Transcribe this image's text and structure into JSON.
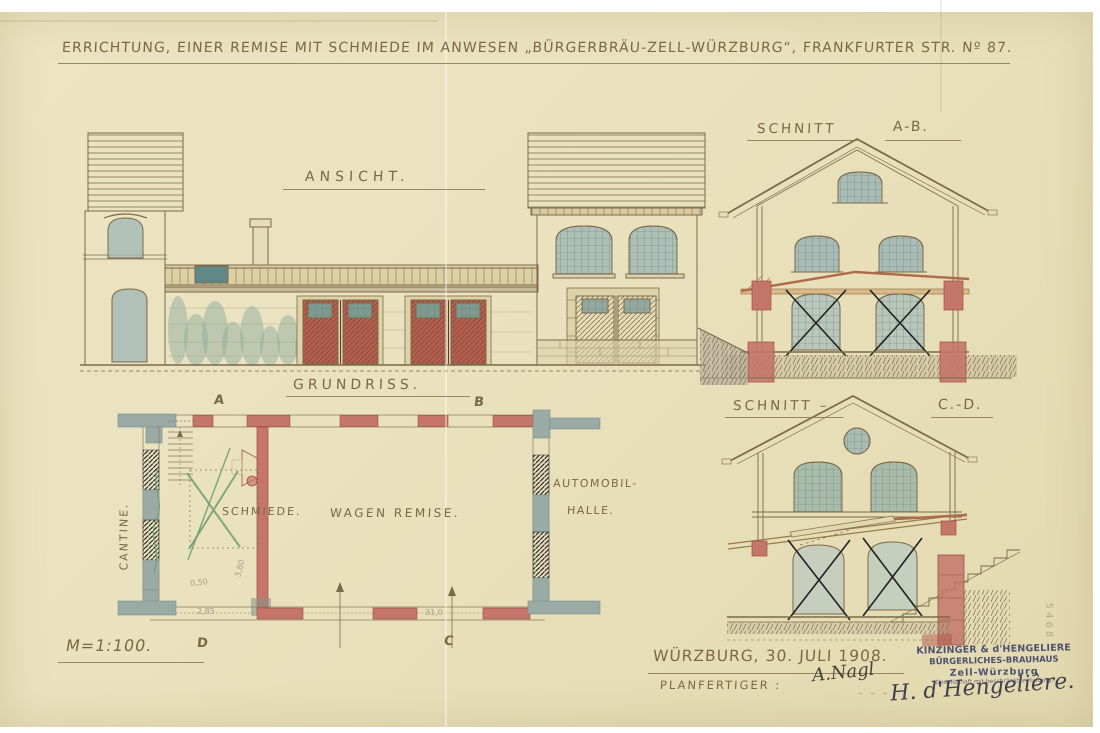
{
  "title": {
    "text": "ERRICHTUNG, EINER REMISE MIT SCHMIEDE IM ANWESEN „BÜRGERBRÄU-ZELL-WÜRZBURG“, FRANKFURTER STR. Nº 87."
  },
  "views": {
    "ansicht": {
      "label": "ANSICHT."
    },
    "schnitt_ab": {
      "label": "SCHNITT",
      "marks": "A-B."
    },
    "schnitt_cd": {
      "label": "SCHNITT –",
      "marks": "C.-D."
    },
    "grundriss": {
      "label": "GRUNDRISS."
    }
  },
  "plan": {
    "rooms": {
      "cantine": "CANTINE.",
      "schmiede": "SCHMIEDE.",
      "wagen_remise": "WAGEN REMISE.",
      "automobil_line1": "AUTOMOBIL-",
      "automobil_line2": "HALLE."
    },
    "section_markers": {
      "a": "A",
      "b": "B",
      "c": "C",
      "d": "D"
    },
    "dimensions": {
      "d1": "0,50",
      "d2": "2,85",
      "d3": "3,80",
      "d4": "31,0"
    },
    "notes": {
      "schmiede_crossed_out": "green X",
      "lower_windows_crossed_out": "black X"
    }
  },
  "footer": {
    "scale": "M=1:100.",
    "place_date": "WÜRZBURG, 30. JULI 1908.",
    "maker_label": "PLANFERTIGER :",
    "maker_signature": "A.Nagl",
    "dashes": "– – –"
  },
  "stamp": {
    "line1": "KINZINGER & d'HENGELIERE",
    "line2": "BÜRGERLICHES-BRAUHAUS",
    "line3": "Zell-Würzburg",
    "line4": "Gesellschaft mit beschränkter Haftung.",
    "signature": "H. d'Hengelière."
  },
  "archive_number": "5468",
  "colors": {
    "paper": "#eae2bf",
    "ink": "#7b6844",
    "red_masonry": "#c4766a",
    "grey_wall": "#9aaaa5",
    "glass_wash": "#a3b9b6",
    "foliage_green": "#8fae9e",
    "cross_green": "#6f9e6f",
    "stamp_ink": "#4d5170",
    "timber": "#b06a4c"
  }
}
